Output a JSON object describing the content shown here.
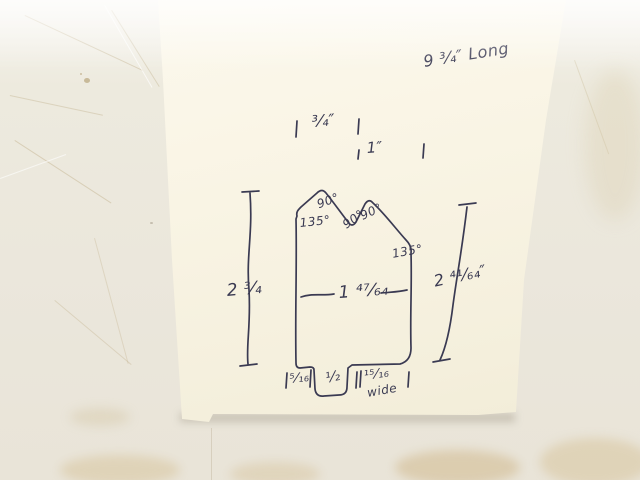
{
  "colors": {
    "ink": "#3a3a52",
    "paper": "#f8f3e3",
    "background": "#eae6dc",
    "stain": "#cdb489"
  },
  "sketch": {
    "note_long": "9 ³⁄₄″ Long",
    "top_ticks": {
      "row1": "³⁄₄″",
      "row2": "1″"
    },
    "angles": {
      "left_peak": "90°",
      "left_shoulder": "135°",
      "valley": "90°",
      "right_peak": "90°",
      "right_shoulder": "135°"
    },
    "dimensions": {
      "left_height": "2 ³⁄₄",
      "right_height": "2 ⁴¹⁄₆₄″",
      "inner_width": "1 ⁴⁷⁄₆₄",
      "bottom_left": "⁵⁄₁₆",
      "notch_width": "¹⁄₂",
      "bottom_right": "¹⁵⁄₁₆",
      "bottom_right_word": "wide"
    }
  }
}
